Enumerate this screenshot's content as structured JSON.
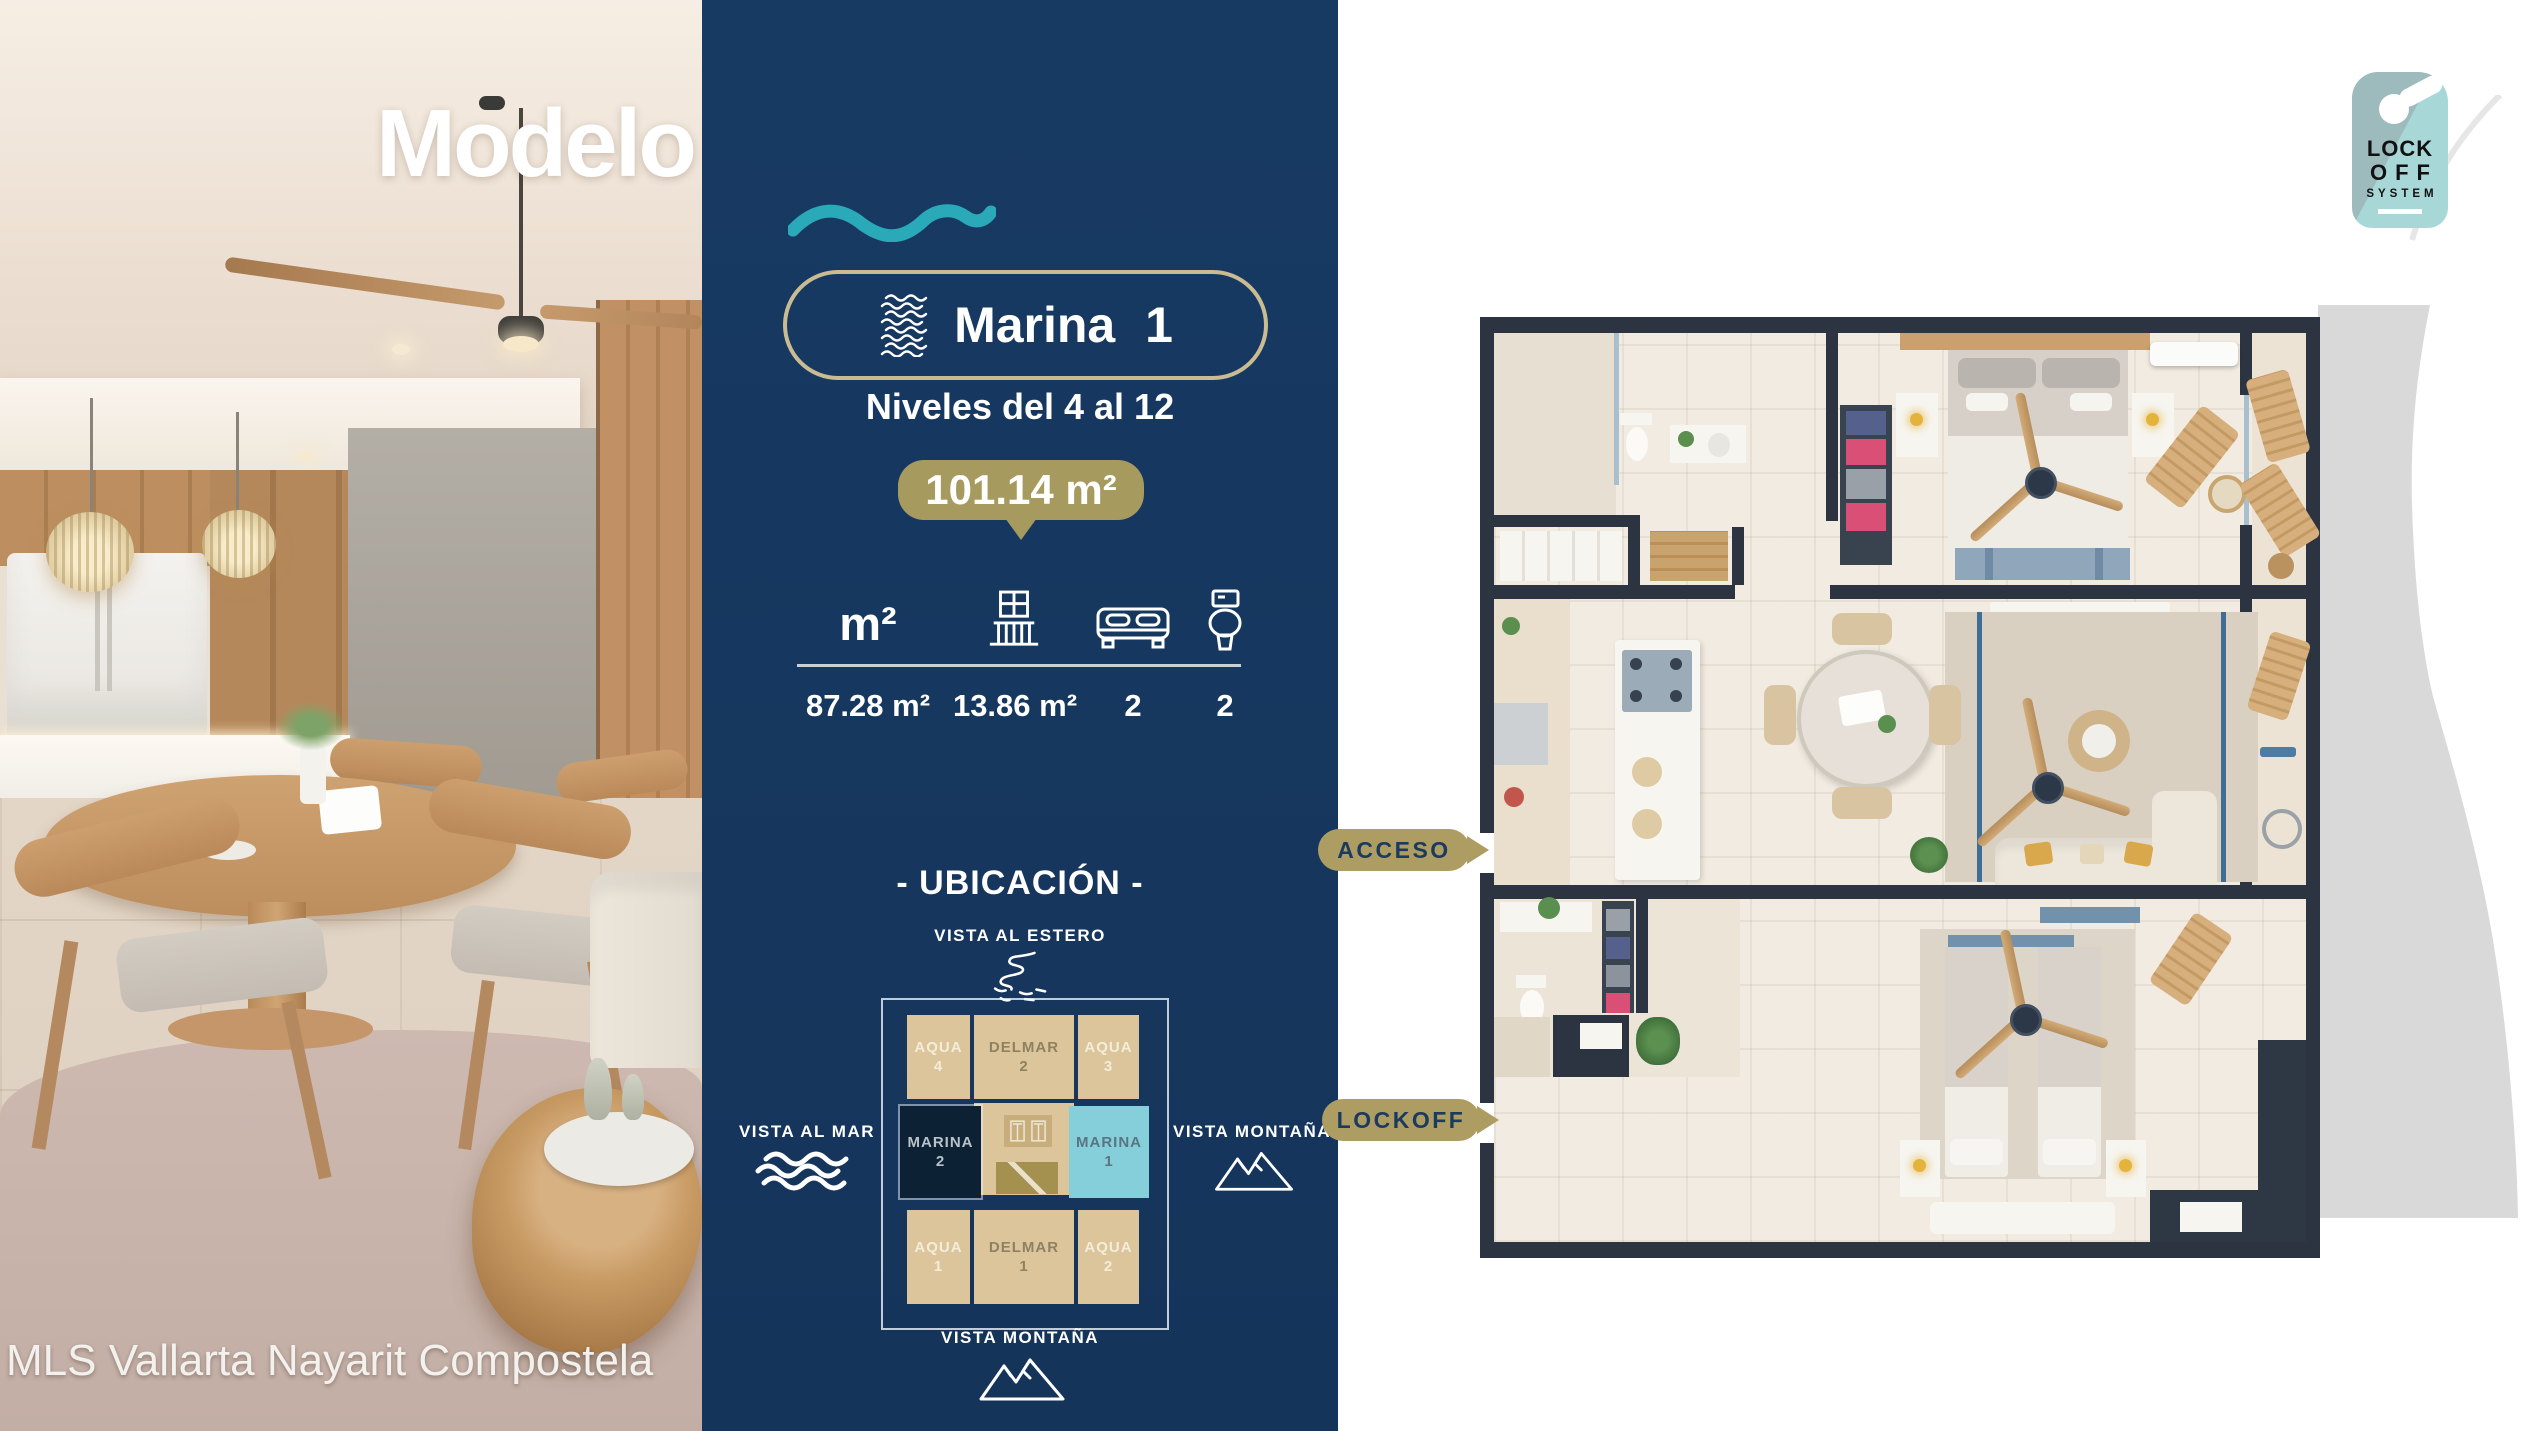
{
  "title": {
    "part1": "Modelo",
    "part2": "Marina"
  },
  "panel": {
    "unit_badge": {
      "label": "Marina 1"
    },
    "levels_label": "Niveles del 4 al 12",
    "area_badge": "101.14 m²",
    "specs": {
      "area_header": "m²",
      "items": [
        {
          "name": "interior-area",
          "value": "87.28 m²"
        },
        {
          "name": "terrace-area",
          "value": "13.86 m²"
        },
        {
          "name": "bedrooms",
          "value": "2"
        },
        {
          "name": "bathrooms",
          "value": "2"
        }
      ]
    },
    "ubicacion": {
      "title": "- UBICACIÓN -",
      "view_top": "VISTA AL ESTERO",
      "view_left": "VISTA AL MAR",
      "view_right": "VISTA MONTAÑA",
      "view_bottom": "VISTA MONTAÑA",
      "units": [
        {
          "name": "AQUA",
          "number": "4"
        },
        {
          "name": "DELMAR",
          "number": "2"
        },
        {
          "name": "AQUA",
          "number": "3"
        },
        {
          "name": "MARINA",
          "number": "2"
        },
        {
          "name": "MARINA",
          "number": "1"
        },
        {
          "name": "AQUA",
          "number": "1"
        },
        {
          "name": "DELMAR",
          "number": "1"
        },
        {
          "name": "AQUA",
          "number": "2"
        }
      ]
    }
  },
  "callouts": {
    "acceso": "ACCESO",
    "lockoff": "LOCKOFF"
  },
  "lockoff_logo": {
    "line1": "LOCK",
    "line2": "OFF",
    "line3": "SYSTEM"
  },
  "watermark": "MLS Vallarta Nayarit Compostela",
  "colors": {
    "navy": "#16365d",
    "gold_badge": "#a79a5f",
    "callout_gold": "#ad9d63",
    "pill_border": "#cabc92",
    "teal_wave": "#2aa9b8",
    "tan_block": "#dcc49b",
    "marina1_cyan": "#85cfdb",
    "marina2_dark": "#0c2133",
    "plan_wall": "#2b3440",
    "logo_teal_top": "#9dbabc",
    "logo_teal_bottom": "#a8d7d8",
    "swoosh_gray": "#d9d9d9"
  }
}
